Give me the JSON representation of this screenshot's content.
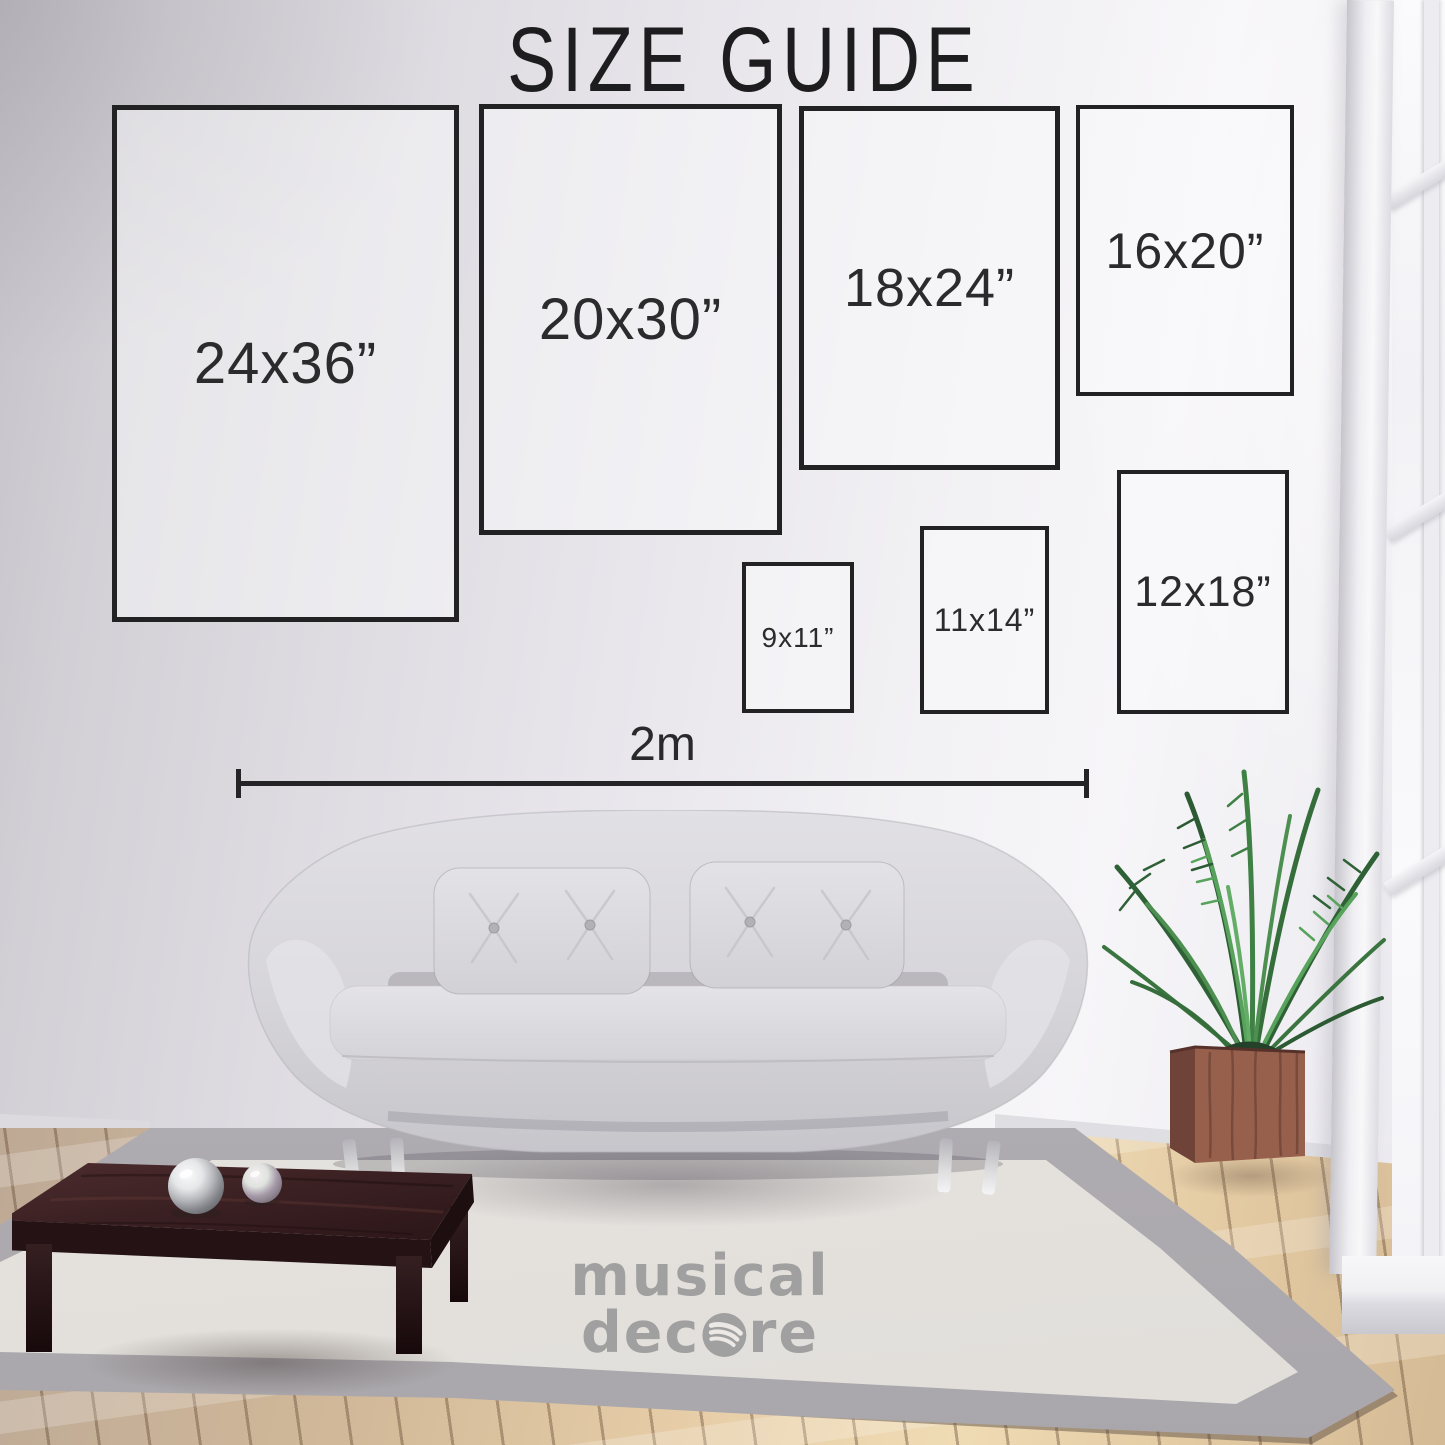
{
  "title": "SIZE GUIDE",
  "size_boxes": [
    {
      "label": "24x36”",
      "x": 112,
      "y": 105,
      "w": 337,
      "h": 507,
      "border": 5,
      "font": 58
    },
    {
      "label": "20x30”",
      "x": 479,
      "y": 104,
      "w": 293,
      "h": 421,
      "border": 5,
      "font": 58
    },
    {
      "label": "18x24”",
      "x": 799,
      "y": 106,
      "w": 251,
      "h": 354,
      "border": 5,
      "font": 54
    },
    {
      "label": "16x20”",
      "x": 1076,
      "y": 105,
      "w": 210,
      "h": 283,
      "border": 4,
      "font": 50
    },
    {
      "label": "9x11”",
      "x": 742,
      "y": 562,
      "w": 104,
      "h": 143,
      "border": 4,
      "font": 28
    },
    {
      "label": "11x14”",
      "x": 920,
      "y": 526,
      "w": 121,
      "h": 180,
      "border": 4,
      "font": 32
    },
    {
      "label": "12x18”",
      "x": 1117,
      "y": 470,
      "w": 164,
      "h": 236,
      "border": 4,
      "font": 43
    }
  ],
  "dimension_line": {
    "label": "2m",
    "x1": 236,
    "x2": 1089,
    "y": 783
  },
  "watermark": {
    "line1": "musical",
    "line2_pre": "dec",
    "line2_post": "re",
    "icon": "spotify-style-circle"
  },
  "colors": {
    "outline": "#222225",
    "wall": "#e9e7ec",
    "rug": "#ebe8e4",
    "rug_border": "#b3b0b5",
    "wood_warm": "#e6cda7",
    "wood_cool": "#b7a18e",
    "sofa": "#d9d8dc",
    "table_wood": "#3c2325",
    "plant_green": "#3c7a40",
    "planter_wood": "#8d5c4b",
    "watermark_gray": "#9b9b9b"
  }
}
